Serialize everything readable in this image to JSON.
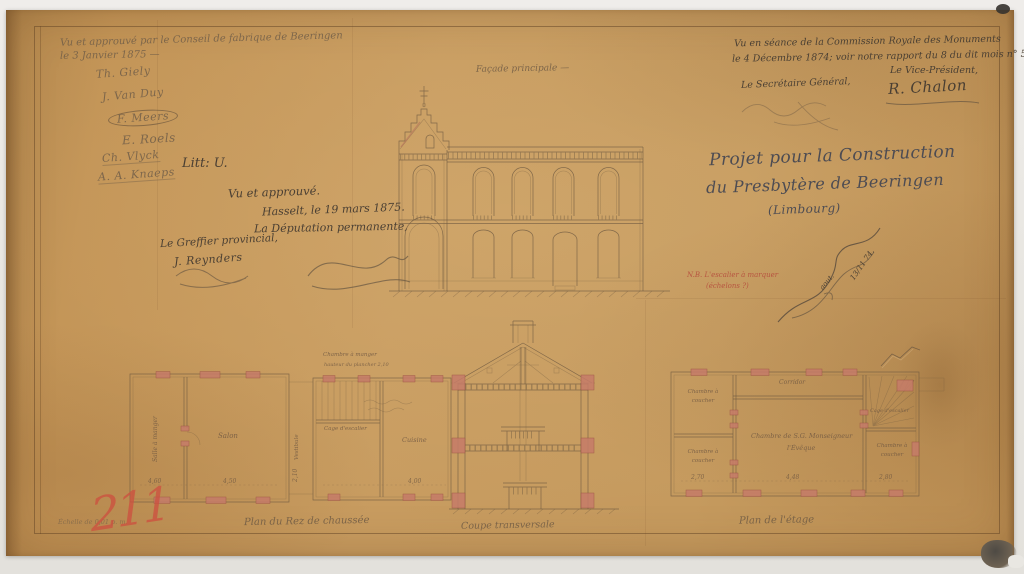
{
  "palette": {
    "paper": "#c49a5e",
    "ink": "#57483a",
    "pencil": "#6e5c48",
    "red_chalk": "#cd5240",
    "pier_pink": "#c67c69"
  },
  "fabrique": {
    "line1": "Vu et approuvé par le Conseil de fabrique de Beeringen",
    "line2": "le 3 Janvier 1875 —",
    "signatures": [
      "Th. Giely",
      "J. Van Duy",
      "F. Meers",
      "E. Roels",
      "Ch. Vlyck",
      "A. A. Knaeps"
    ]
  },
  "litt": "Litt: U.",
  "deputation": {
    "approved": "Vu et approuvé.",
    "place_date": "Hasselt, le 19 mars 1875.",
    "body": "La Députation permanente,",
    "clerk_title": "Le Greffier provincial,",
    "clerk_signature": "J. Reynders"
  },
  "commission": {
    "line1": "Vu en séance de la Commission Royale des Monuments",
    "line2": "le 4 Décembre 1874; voir notre rapport du 8 du dit mois n° 5783.",
    "vice_title": "Le Vice-Président,",
    "vice_signature": "R. Chalon",
    "secretary_title": "Le Secrétaire Général,"
  },
  "title_block": {
    "line1": "Projet pour la Construction",
    "line2": "du Presbytère de Beeringen",
    "line3": "(Limbourg)"
  },
  "red_note": {
    "line1": "N.B. L'escalier à marquer",
    "line2": "(échelons ?)"
  },
  "architect": {
    "word": "aout.",
    "date": "13/11 74."
  },
  "facade": {
    "caption": "Façade principale —"
  },
  "ground_plan": {
    "caption": "Plan du Rez de chaussée",
    "room_left": "Salle à manger",
    "room_center": "Salon",
    "room_annex": "Cuisine",
    "corridor": "Vestibule",
    "stair": "Cage d'escalier",
    "note1": "Chambre à manger",
    "note2": "hauteur du plancher 2,10",
    "dims": [
      "4,60",
      "4,50",
      "2,10",
      "4,00"
    ]
  },
  "section": {
    "caption": "Coupe transversale"
  },
  "floor_plan": {
    "caption": "Plan de l'étage",
    "corridor": "Corridor",
    "room_top_left": "Chambre à coucher",
    "room_bottom_left": "Chambre à coucher",
    "room_center_1": "Chambre de S.G. Monseigneur",
    "room_center_2": "l'Évêque",
    "room_right": "Chambre à coucher",
    "stair": "Cage d'escalier",
    "dims": [
      "2,70",
      "4,48",
      "2,80"
    ]
  },
  "footer": {
    "scale": "Échelle de 0,01 p. m.",
    "number": "211"
  }
}
